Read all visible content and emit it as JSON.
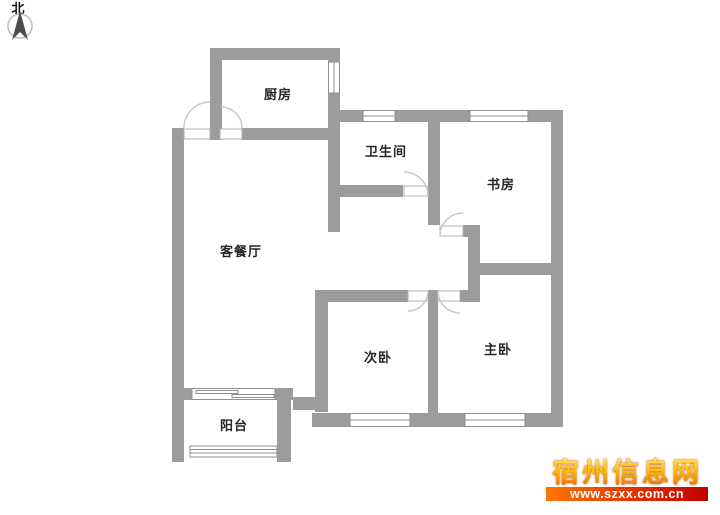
{
  "compass": {
    "label": "北"
  },
  "rooms": [
    {
      "name": "厨房"
    },
    {
      "name": "卫生间"
    },
    {
      "name": "书房"
    },
    {
      "name": "客餐厅"
    },
    {
      "name": "次卧"
    },
    {
      "name": "主卧"
    },
    {
      "name": "阳台"
    }
  ],
  "watermark": {
    "site_name": "宿州信息网",
    "url": "www.szxx.com.cn",
    "name_color_top": "#ffe95e",
    "name_color_bottom": "#e85d00",
    "bar_color_left": "#ff7700",
    "bar_color_right": "#c00000"
  },
  "colors": {
    "wall": "#9c9c9c",
    "door_arc": "#c9c9c9",
    "label_text": "#262626",
    "background": "#ffffff"
  }
}
